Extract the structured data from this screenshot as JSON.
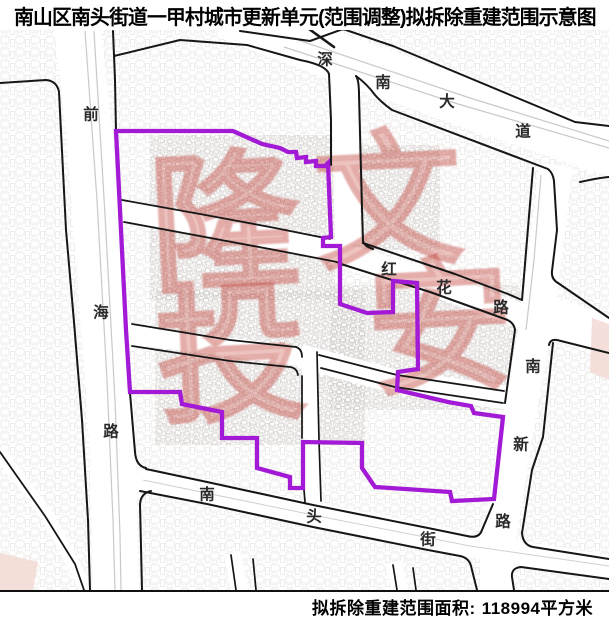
{
  "title": "南山区南头街道一甲村城市更新单元(范围调整)拟拆除重建范围示意图",
  "footer": {
    "area_label": "拟拆除重建范围面积:",
    "area_value": "118994平方米"
  },
  "map": {
    "boundary_color": "#A31AD6",
    "boundary_name": "拟拆除重建范围",
    "road_names": [
      "前海路",
      "深南大道",
      "红花路",
      "南新路",
      "南头街"
    ],
    "road_labels": [
      {
        "road": "qianhai-lu",
        "char": "前",
        "x": 91,
        "y": 114
      },
      {
        "road": "qianhai-lu",
        "char": "海",
        "x": 101,
        "y": 312
      },
      {
        "road": "qianhai-lu",
        "char": "路",
        "x": 111,
        "y": 431
      },
      {
        "road": "shennan-dadao",
        "char": "深",
        "x": 325,
        "y": 59
      },
      {
        "road": "shennan-dadao",
        "char": "南",
        "x": 383,
        "y": 82
      },
      {
        "road": "shennan-dadao",
        "char": "大",
        "x": 447,
        "y": 101
      },
      {
        "road": "shennan-dadao",
        "char": "道",
        "x": 523,
        "y": 131
      },
      {
        "road": "honghua-lu",
        "char": "红",
        "x": 389,
        "y": 269
      },
      {
        "road": "honghua-lu",
        "char": "花",
        "x": 444,
        "y": 287
      },
      {
        "road": "honghua-lu",
        "char": "路",
        "x": 501,
        "y": 307
      },
      {
        "road": "nanxin-lu",
        "char": "南",
        "x": 533,
        "y": 366
      },
      {
        "road": "nanxin-lu",
        "char": "新",
        "x": 521,
        "y": 444
      },
      {
        "road": "nanxin-lu",
        "char": "路",
        "x": 503,
        "y": 521
      },
      {
        "road": "nantou-jie",
        "char": "南",
        "x": 207,
        "y": 494
      },
      {
        "road": "nantou-jie",
        "char": "头",
        "x": 314,
        "y": 516
      },
      {
        "road": "nantou-jie",
        "char": "街",
        "x": 428,
        "y": 539
      }
    ],
    "watermark": {
      "color": "rgba(197,56,48,0.30)",
      "stroke_color": "rgba(176,40,34,0.16)",
      "legibility": "stylized-illegible",
      "characters": [
        {
          "char": "隆",
          "x": 228,
          "y": 220,
          "size": 150
        },
        {
          "char": "文",
          "x": 393,
          "y": 207,
          "size": 148
        },
        {
          "char": "投",
          "x": 228,
          "y": 352,
          "size": 150
        },
        {
          "char": "安",
          "x": 438,
          "y": 336,
          "size": 146
        }
      ]
    }
  }
}
